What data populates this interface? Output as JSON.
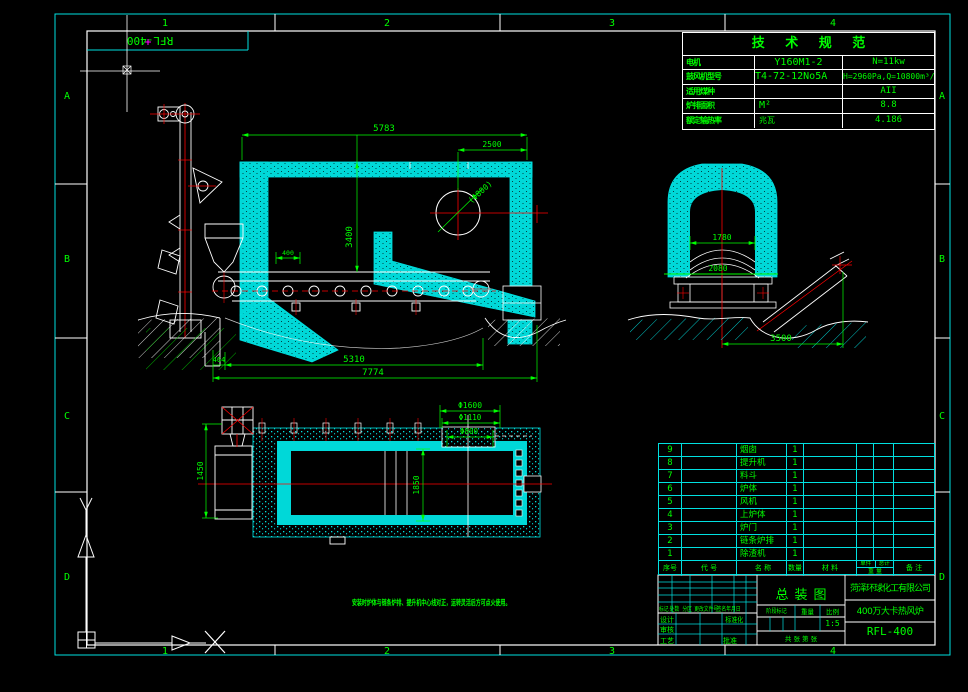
{
  "sheet": {
    "zones_top": [
      "1",
      "2",
      "3",
      "4"
    ],
    "zones_bottom": [
      "1",
      "2",
      "3",
      "4"
    ],
    "zones_left": [
      "A",
      "B",
      "C",
      "D"
    ],
    "zones_right": [
      "A",
      "B",
      "C",
      "D"
    ],
    "corner_label": "RFL-400"
  },
  "tech_table": {
    "title": "技 术 规 范",
    "rows": [
      {
        "label": "电机",
        "value1": "Y160M1-2",
        "value2": "N=11kw"
      },
      {
        "label": "鼓风机型号",
        "value1": "T4-72-12No5A",
        "value2": "H=2960Pa,Q=10800m³/h"
      },
      {
        "label": "适用煤种",
        "value1": "",
        "value2": "AII"
      },
      {
        "label": "炉排面积",
        "value1": "M²",
        "value2": "8.8"
      },
      {
        "label": "额定输热率",
        "value1": "兆瓦",
        "value2": "4.186"
      }
    ]
  },
  "bom": {
    "headers": {
      "no": "序号",
      "code": "代 号",
      "name": "名 称",
      "qty": "数量",
      "material": "材 料",
      "unit": "单件",
      "total": "总计",
      "weight": "重 量",
      "remark": "备 注"
    },
    "rows": [
      {
        "no": "9",
        "code": "",
        "name": "烟囱",
        "qty": "1",
        "material": ""
      },
      {
        "no": "8",
        "code": "",
        "name": "提升机",
        "qty": "1",
        "material": ""
      },
      {
        "no": "7",
        "code": "",
        "name": "料斗",
        "qty": "1",
        "material": ""
      },
      {
        "no": "6",
        "code": "",
        "name": "炉体",
        "qty": "1",
        "material": ""
      },
      {
        "no": "5",
        "code": "",
        "name": "风机",
        "qty": "1",
        "material": ""
      },
      {
        "no": "4",
        "code": "",
        "name": "上炉体",
        "qty": "1",
        "material": ""
      },
      {
        "no": "3",
        "code": "",
        "name": "炉门",
        "qty": "1",
        "material": ""
      },
      {
        "no": "2",
        "code": "",
        "name": "链条炉排",
        "qty": "1",
        "material": ""
      },
      {
        "no": "1",
        "code": "",
        "name": "除渣机",
        "qty": "1",
        "material": ""
      }
    ]
  },
  "title_block": {
    "company": "菏泽环球化工有限公司",
    "drawing_title": "总装图",
    "product": "400万大卡热风炉",
    "drawing_no": "RFL-400",
    "rev_headers": [
      "标记",
      "处数",
      "分区",
      "更改文件号",
      "签名",
      "年月日"
    ],
    "left_labels": {
      "design": "设计",
      "check": "审核",
      "process": "工艺",
      "standard": "标准化",
      "approve": "批准"
    },
    "mid_labels": {
      "stage": "阶段标记",
      "weight": "重量",
      "scale": "比例"
    },
    "scale_value": "1:5",
    "sheet_info": "共 张 第 张"
  },
  "note": "安装时炉体与链条炉排、提升机中心线对正，运转灵活后方可点火使用。",
  "dims": {
    "front": {
      "overall_top": "5783",
      "top_right": "2500",
      "height": "3400",
      "flue": "(Φ800)",
      "left_small": "464",
      "grate": "5310",
      "overall_bottom": "7774",
      "sprocket": "400"
    },
    "side": {
      "inner_width": "1780",
      "inner_height": "2080",
      "bottom": "3500"
    },
    "plan": {
      "d1": "Φ1600",
      "d2": "Φ1110",
      "d3": "Φ800",
      "left": "1450",
      "inner": "1850"
    }
  }
}
